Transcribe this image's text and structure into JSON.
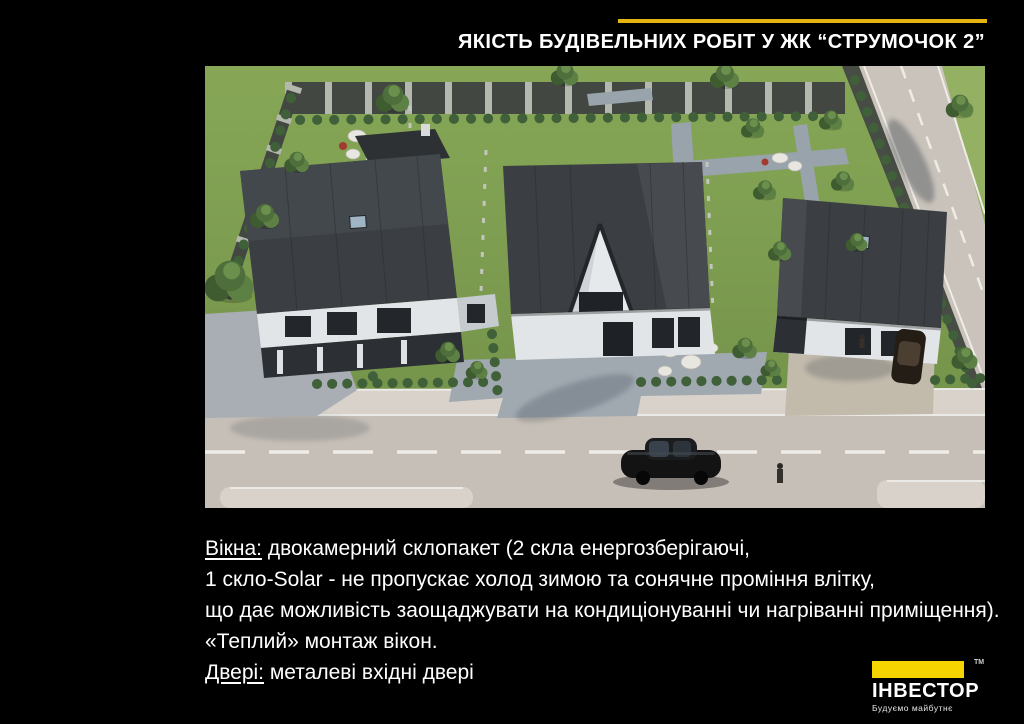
{
  "colors": {
    "accent": "#e5b411",
    "brand_yellow": "#f5d400",
    "background": "#000000",
    "text": "#ffffff"
  },
  "header": {
    "title": "ЯКІСТЬ БУДІВЕЛЬНИХ РОБІТ У ЖК “СТРУМОЧОК 2”"
  },
  "image": {
    "description": "aerial 3D render of three cottages with dark roofs, green fenced gardens, paved driveways, street with parked black car"
  },
  "body": {
    "line1_label": "Вікна:",
    "line1_rest": " двокамерний склопакет (2 скла енергозберігаючі,",
    "line2": "1 скло-Solar - не пропускає холод зимою та сонячне проміння влітку,",
    "line3": "що дає можливість заощаджувати на кондиціонуванні чи нагріванні приміщення).",
    "line4": "«Теплий» монтаж вікон.",
    "line5_label": "Двері:",
    "line5_rest": " металеві вхідні двері"
  },
  "logo": {
    "trademark": "ТМ",
    "brand": "ІНВЕСТОР",
    "tagline": "Будуємо майбутнє"
  }
}
